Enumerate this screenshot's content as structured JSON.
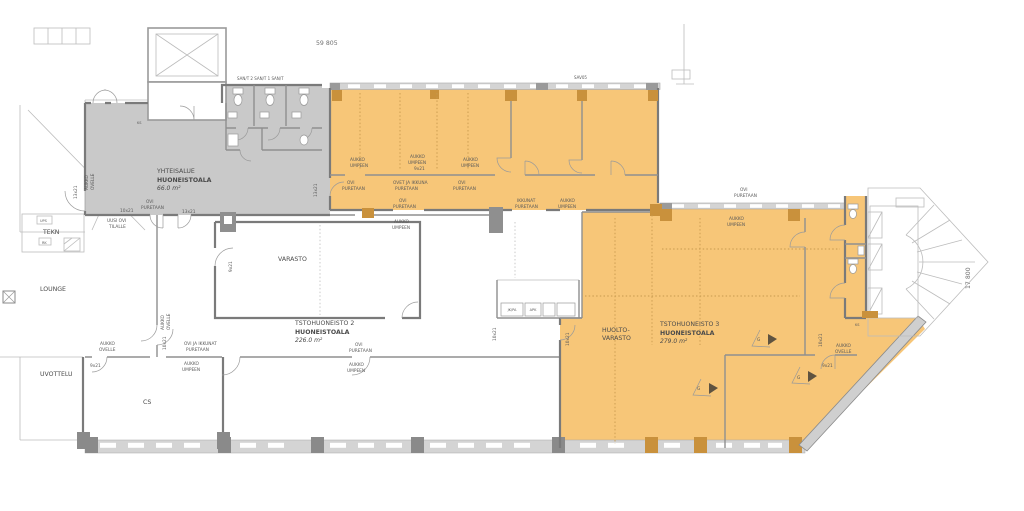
{
  "colors": {
    "highlight_orange": "#f7c678",
    "column_orange": "#c9913c",
    "common_gray": "#c9c9c9",
    "wall_dark": "#7a7a7a",
    "wall_light": "#bcbcbc",
    "window_band": "#d4d4d4"
  },
  "dimensions": {
    "top": "59 805",
    "right": "17 800"
  },
  "areas": {
    "yhteisalue": {
      "name": "YHTEISALUE",
      "kind": "HUONEISTOALA",
      "size": "66.0 m²"
    },
    "tsto2": {
      "name": "TSTOHUONEISTO 2",
      "kind": "HUONEISTOALA",
      "size": "226.0 m²"
    },
    "tsto3": {
      "name": "TSTOHUONEISTO 3",
      "kind": "HUONEISTOALA",
      "size": "279.0 m²"
    }
  },
  "rooms": {
    "varasto": "VARASTO",
    "huolto_line1": "HUOLTO-",
    "huolto_line2": "VARASTO",
    "lounge": "LOUNGE",
    "neuvottelu": "UVOTTELU",
    "cs": "CS",
    "tekn": "TEKN",
    "ups": "UPS",
    "rk": "RK",
    "ks": "KS",
    "san_row": "SAN/T 2 SAN/T 1 SAN/T",
    "sav": "SAV05",
    "jk_pa": "JK/PA",
    "apk": "APK"
  },
  "notes": {
    "aukko": "AUKKO",
    "umpeen": "UMPEEN",
    "ovi": "OVI",
    "puretaan": "PURETAAN",
    "ovet_ja_ikkuna": "OVET JA IKKUNA",
    "ovi_ja_ikkunat": "OVI JA IKKUNAT",
    "ikkunat": "IKKUNAT",
    "ovelle": "OVELLE",
    "uusi_ovi": "UUSI OVI",
    "tilalle": "TILALLE",
    "g_mark": "G"
  },
  "door_sizes": {
    "d9": "9x21",
    "d10": "10x21",
    "d13": "13x21"
  }
}
